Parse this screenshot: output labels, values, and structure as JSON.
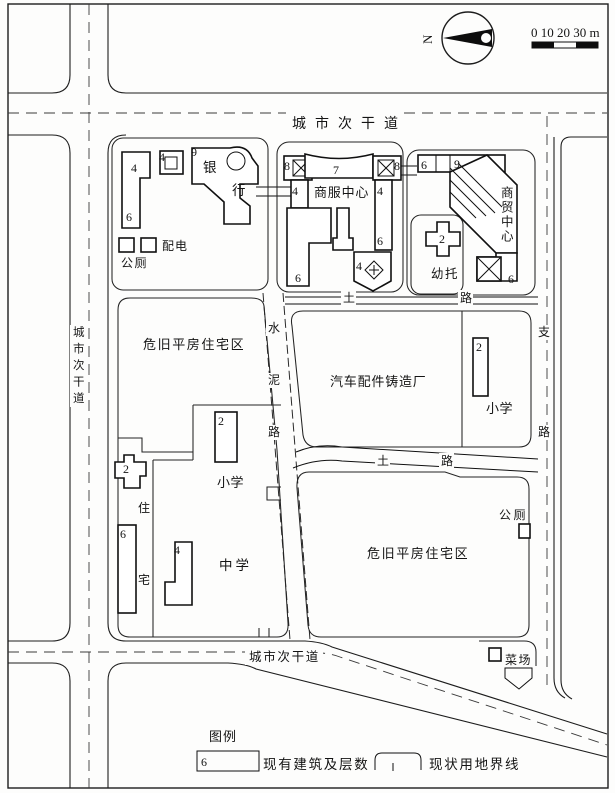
{
  "map": {
    "compass": {
      "north": "N"
    },
    "scale": {
      "label": "0 10 20 30 m"
    },
    "roads": {
      "top": "城市次干道",
      "left": "城市次干道",
      "bottom": "城市次干道",
      "branch": "支路",
      "cement": "水泥路",
      "dirt_upper": "土路",
      "dirt_lower": "土路"
    },
    "places": {
      "bank": "银行",
      "commerce_service": "商服中心",
      "trade_center": "商贸中心",
      "nursery": "幼托",
      "power": "配电",
      "toilet_nw": "公厕",
      "toilet_se": "公厕",
      "old_housing_nw": "危旧平房住宅区",
      "old_housing_se": "危旧平房住宅区",
      "foundry": "汽车配件铸造厂",
      "primary_school_e": "小学",
      "primary_school_w": "小学",
      "middle_school": "中学",
      "residence": "住宅",
      "market": "菜场"
    },
    "floors": {
      "nw_bar_top": "4",
      "nw_bar_bottom": "6",
      "nw_square": "4",
      "bank": "9",
      "cs_tower_left": "8",
      "cs_stem_left": "4",
      "cs_building_left": "6",
      "cs_bar": "7",
      "cs_tower_right": "8",
      "cs_stem_right_top": "4",
      "cs_stem_right_bottom": "6",
      "cs_diamond": "4",
      "tc_top_left": "6",
      "tc_top": "9",
      "tc_annex": "6",
      "nursery": "2",
      "foundry_school": "2",
      "school_west": "2",
      "residence_small": "2",
      "residence_slab": "6",
      "residence_l": "4"
    },
    "legend": {
      "title": "图例",
      "building_symbol": "6",
      "building_label": "现有建筑及层数",
      "boundary_label": "现状用地界线"
    }
  }
}
